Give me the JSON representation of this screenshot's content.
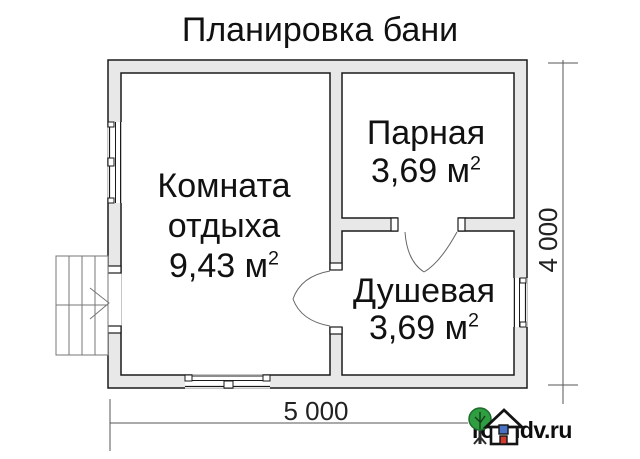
{
  "title": "Планировка бани",
  "rooms": [
    {
      "name": "Комната отдыха",
      "area": "9,43 м",
      "sup": "2"
    },
    {
      "name": "Парная",
      "area": "3,69 м",
      "sup": "2"
    },
    {
      "name": "Душевая",
      "area": "3,69 м",
      "sup": "2"
    }
  ],
  "dimensions": {
    "width_label": "5 000",
    "height_label": "4 000"
  },
  "watermark": {
    "site": "rosndv.ru"
  },
  "icons": {
    "tree": "tree-icon",
    "house": "house-icon"
  },
  "colors": {
    "background": "#ffffff",
    "text": "#111111",
    "line": "#1a1a1a",
    "wall_fill": "#e8e8e8",
    "dim_line": "#555555",
    "stair_line": "#777777",
    "logo_green": "#2f9e41",
    "logo_green_dark": "#1d6b2d",
    "logo_blue": "#4a72c4",
    "logo_red": "#d23b2f"
  }
}
